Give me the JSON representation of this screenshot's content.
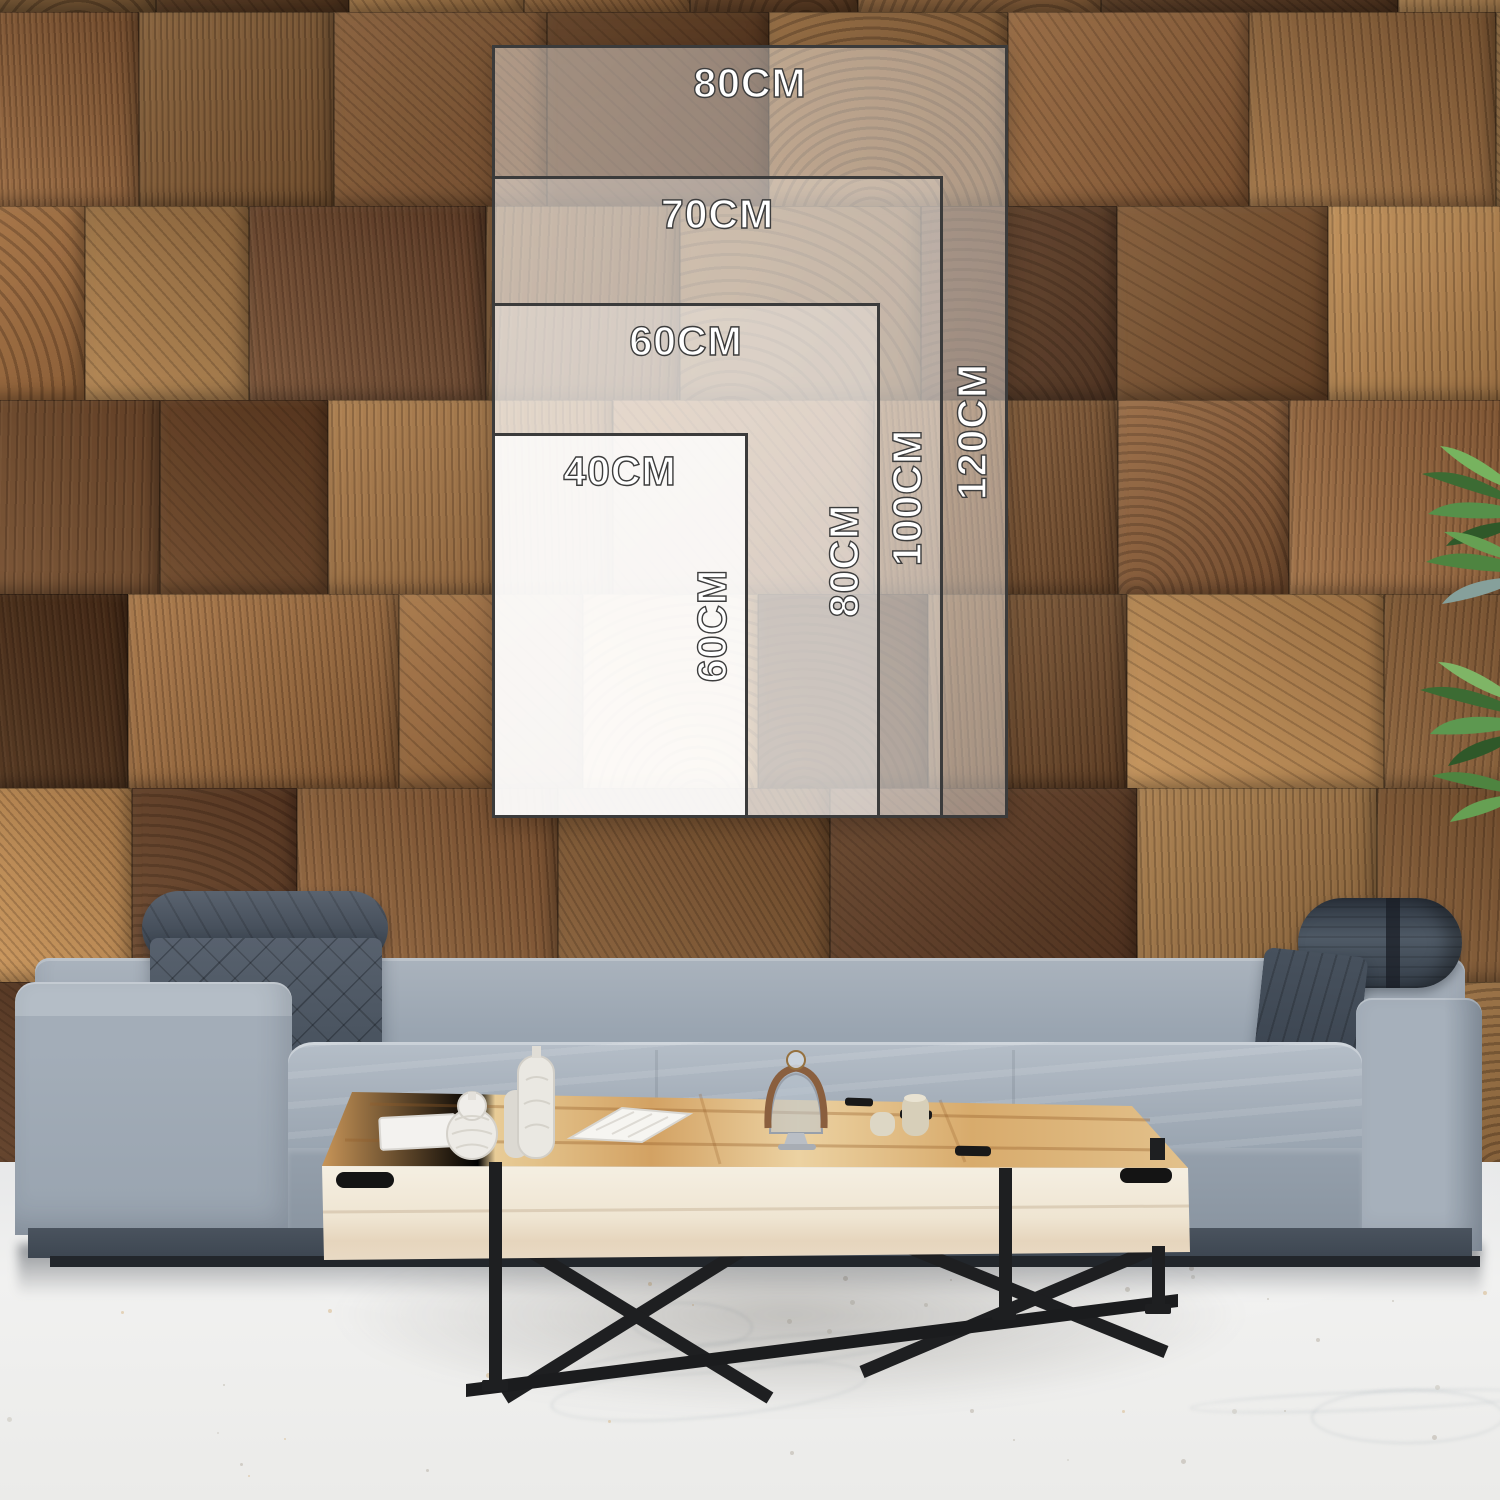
{
  "size_chart": {
    "unit": "CM",
    "options": [
      {
        "width": "80CM",
        "height": "120CM",
        "width_cm": 80,
        "height_cm": 120
      },
      {
        "width": "70CM",
        "height": "100CM",
        "width_cm": 70,
        "height_cm": 100
      },
      {
        "width": "60CM",
        "height": "80CM",
        "width_cm": 60,
        "height_cm": 80
      },
      {
        "width": "40CM",
        "height": "60CM",
        "width_cm": 40,
        "height_cm": 60
      }
    ],
    "overlay_fill_color": "#ffffff",
    "overlay_border_color": "#3b3b3b",
    "label_text_color": "#ffffff"
  },
  "scene": {
    "wall_palette": [
      "#55351e",
      "#63402a",
      "#6e4a2c",
      "#7a5233",
      "#855b38",
      "#93663d",
      "#a37446",
      "#b08350"
    ],
    "floor_color": "#efefee",
    "floor_speck_colors": [
      "#d8ba8c",
      "#c9c4bb",
      "#b9b3a8"
    ],
    "sofa_fabric_color": "#9aa5b1",
    "headrest_color": "#4a5461",
    "table_top_color": "#ddb477",
    "table_face_color": "#f1e8d8",
    "table_frame_color": "#1e1f21",
    "plant_colors": [
      "#39662f",
      "#4e8440",
      "#6aa855",
      "#86a09b"
    ]
  }
}
